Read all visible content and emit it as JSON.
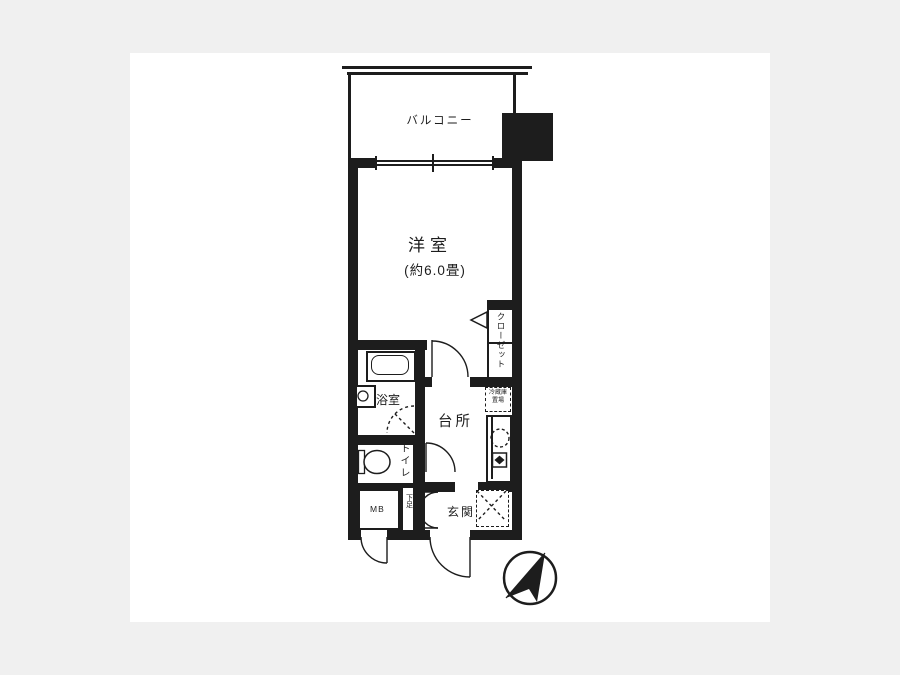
{
  "floorplan": {
    "balcony_label": "バルコニー",
    "main_room": {
      "name": "洋室",
      "size": "(約6.0畳)"
    },
    "closet_label": "クローゼット",
    "bathroom_label": "浴室",
    "kitchen_label": "台所",
    "toilet_label": "トイレ",
    "entrance_label": "玄関",
    "meter_box_label": "MB",
    "shoe_box_label": "下足",
    "fridge_label_line1": "冷蔵庫",
    "fridge_label_line2": "置場",
    "colors": {
      "page_background": "#f0f0f0",
      "panel_background": "#ffffff",
      "line": "#1d1d1d"
    }
  }
}
